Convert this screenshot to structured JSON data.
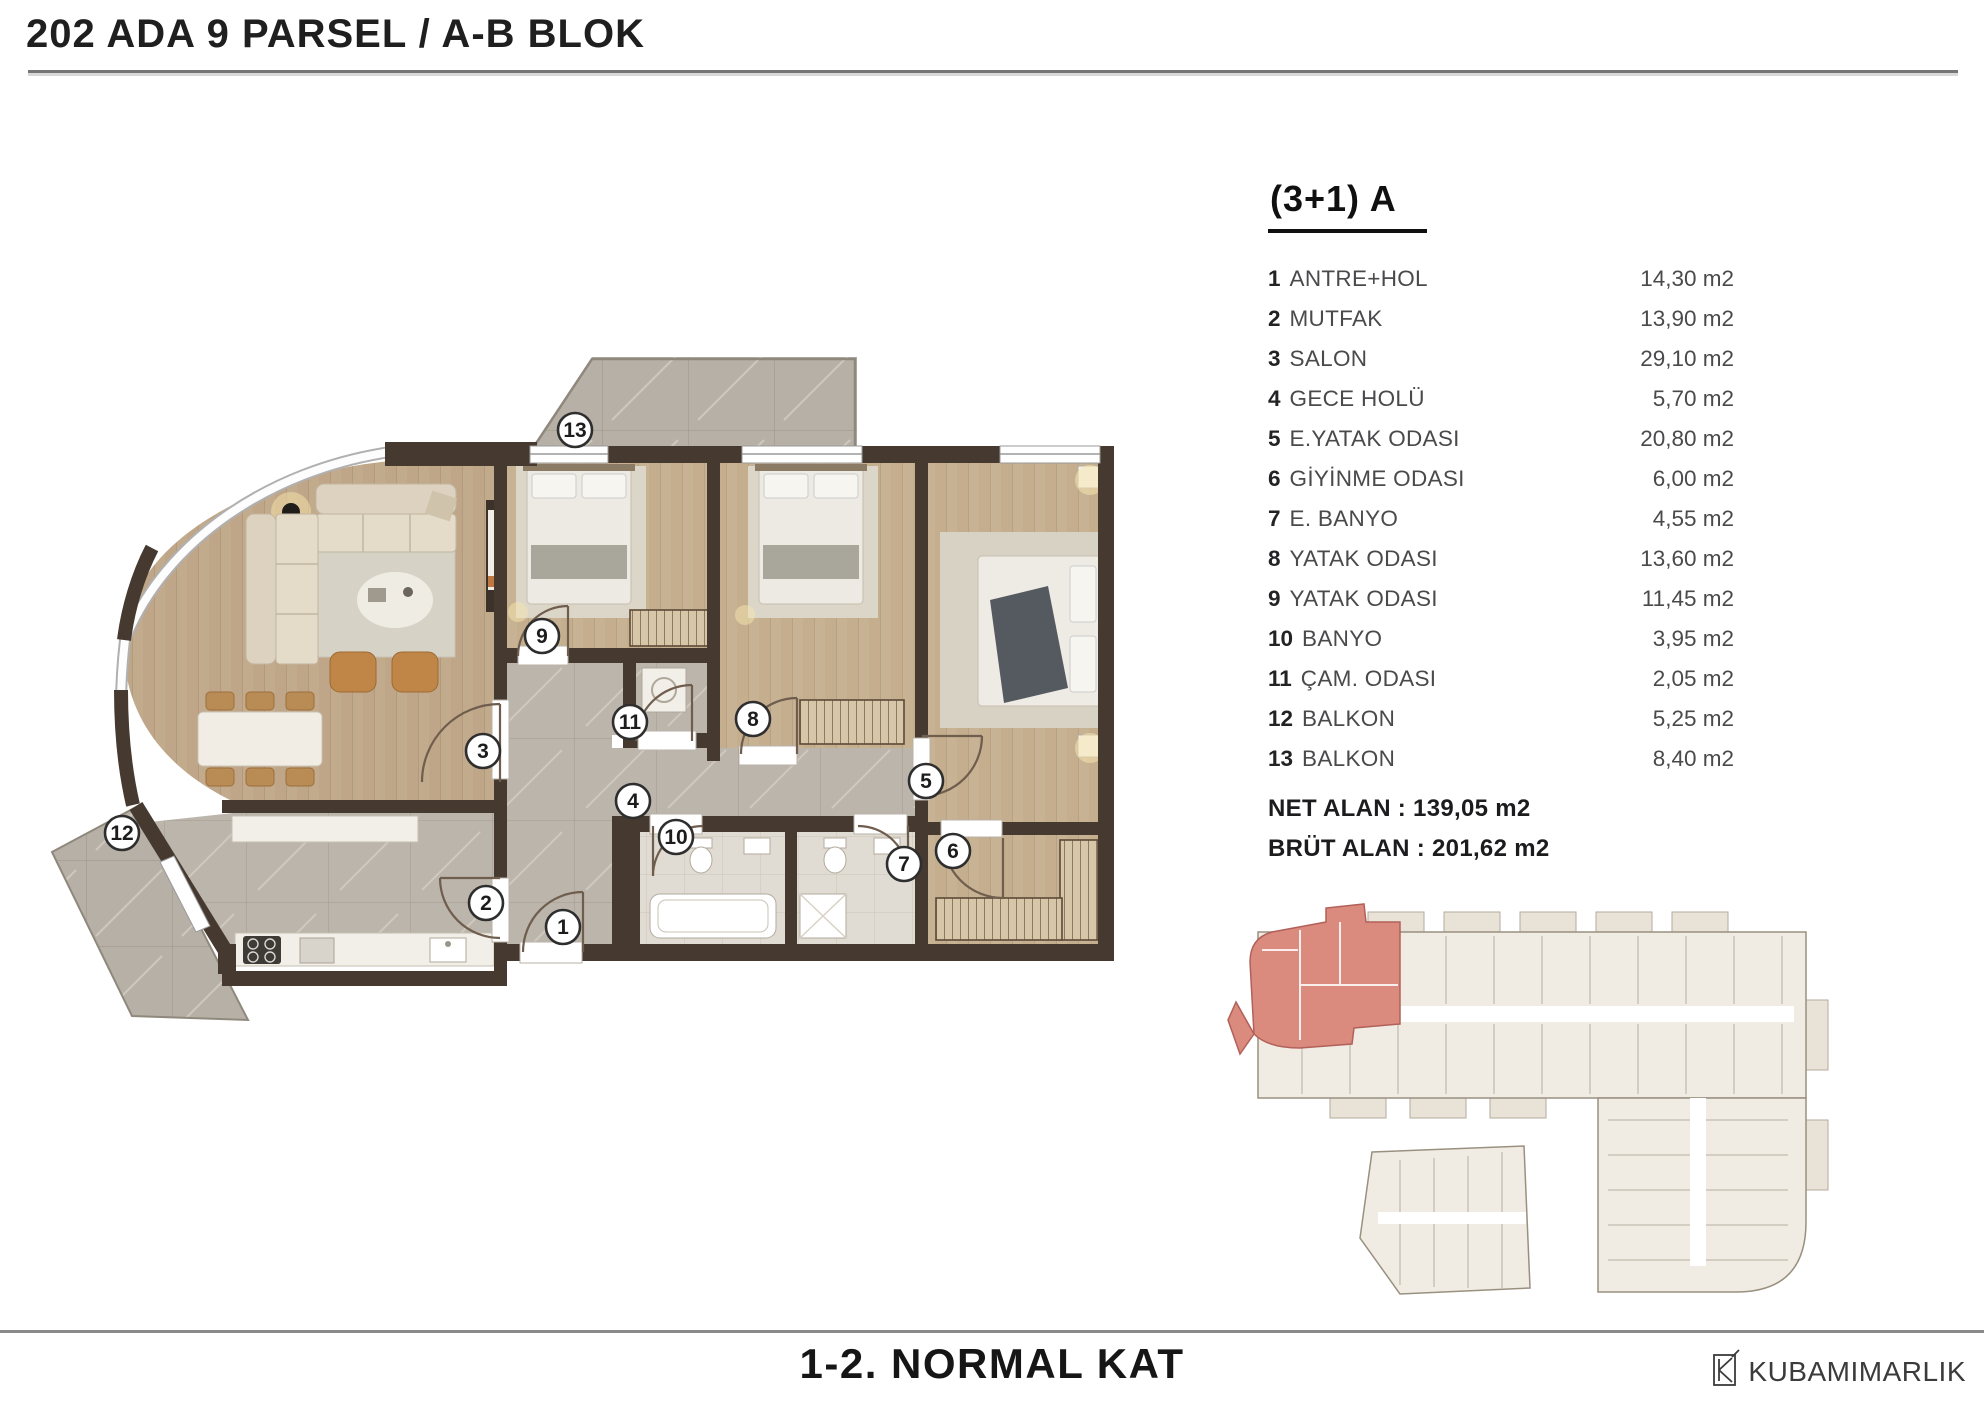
{
  "header": {
    "title": "202 ADA 9 PARSEL / A-B BLOK"
  },
  "legend": {
    "heading": "(3+1) A",
    "rooms": [
      {
        "no": "1",
        "name": "ANTRE+HOL",
        "area": "14,30 m2"
      },
      {
        "no": "2",
        "name": "MUTFAK",
        "area": "13,90 m2"
      },
      {
        "no": "3",
        "name": "SALON",
        "area": "29,10 m2"
      },
      {
        "no": "4",
        "name": "GECE HOLÜ",
        "area": "5,70 m2"
      },
      {
        "no": "5",
        "name": "E.YATAK ODASI",
        "area": "20,80 m2"
      },
      {
        "no": "6",
        "name": "GİYİNME ODASI",
        "area": "6,00 m2"
      },
      {
        "no": "7",
        "name": "E. BANYO",
        "area": "4,55 m2"
      },
      {
        "no": "8",
        "name": "YATAK ODASI",
        "area": "13,60 m2"
      },
      {
        "no": "9",
        "name": "YATAK ODASI",
        "area": "11,45 m2"
      },
      {
        "no": "10",
        "name": "BANYO",
        "area": "3,95 m2"
      },
      {
        "no": "11",
        "name": "ÇAM. ODASI",
        "area": "2,05 m2"
      },
      {
        "no": "12",
        "name": "BALKON",
        "area": "5,25 m2"
      },
      {
        "no": "13",
        "name": "BALKON",
        "area": "8,40 m2"
      }
    ],
    "net_alan": "NET ALAN : 139,05 m2",
    "brut_alan": "BRÜT ALAN : 201,62 m2"
  },
  "plan": {
    "markers": [
      {
        "no": "1"
      },
      {
        "no": "2"
      },
      {
        "no": "3"
      },
      {
        "no": "4"
      },
      {
        "no": "5"
      },
      {
        "no": "6"
      },
      {
        "no": "7"
      },
      {
        "no": "8"
      },
      {
        "no": "9"
      },
      {
        "no": "10"
      },
      {
        "no": "11"
      },
      {
        "no": "12"
      },
      {
        "no": "13"
      }
    ],
    "colors": {
      "wall": "#463a30",
      "wood": "#c2aa8c",
      "wood_light": "#c8b294",
      "marble": "#bcb5ab",
      "balcony": "#b7b0a6",
      "bath": "#e0dcd3",
      "keyplan_fill": "#f1ece3",
      "keyplan_red": "#db8a7e"
    }
  },
  "footer": {
    "title": "1-2. NORMAL KAT",
    "logo": "KUBAMIMARLIK"
  }
}
